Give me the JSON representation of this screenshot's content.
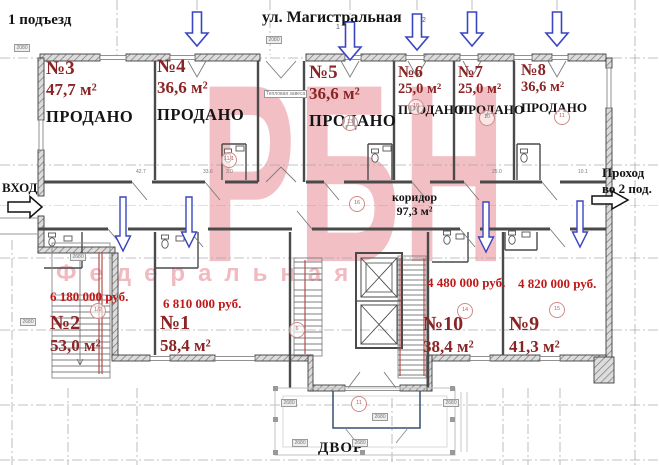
{
  "header": {
    "entrance": "1 подъезд",
    "street": "ул. Магистральная"
  },
  "labels": {
    "entrance_in": "ВХОД",
    "passage_line1": "Проход",
    "passage_line2": "во 2 под.",
    "yard": "ДВОР",
    "corridor_name": "коридор",
    "corridor_area": "97,3 м²",
    "vestibule": "Тепловая завеса"
  },
  "watermark": {
    "main": "РБН",
    "sub": "Федеральная"
  },
  "apartments": {
    "top": [
      {
        "num": "№3",
        "area": "47,7 м²",
        "status": "ПРОДАНО"
      },
      {
        "num": "№4",
        "area": "36,6 м²",
        "status": "ПРОДАНО"
      },
      {
        "num": "№5",
        "area": "36,6 м²",
        "status": "ПРОДАНО"
      },
      {
        "num": "№6",
        "area": "25,0 м²",
        "status": "ПРОДАНО"
      },
      {
        "num": "№7",
        "area": "25,0 м²",
        "status": "ПРОДАНО"
      },
      {
        "num": "№8",
        "area": "36,6 м²",
        "status": "ПРОДАНО"
      }
    ],
    "bottom": [
      {
        "num": "№2",
        "area": "53,0 м²",
        "price": "6 180 000 руб."
      },
      {
        "num": "№1",
        "area": "58,4 м²",
        "price": "6 810 000 руб."
      },
      {
        "num": "№10",
        "area": "38,4 м²",
        "price": "4 480 000 руб."
      },
      {
        "num": "№9",
        "area": "41,3 м²",
        "price": "4 820 000 руб."
      }
    ]
  },
  "tags": [
    "1/2",
    "16",
    "11/1",
    "14",
    "15",
    "10",
    "11",
    "18",
    "13",
    "6",
    "11"
  ],
  "dims": [
    "42.7",
    "33.6",
    "3.0",
    "25.0",
    "10.1"
  ],
  "dim_boxes": [
    "2080",
    "2080",
    "2680",
    "2680",
    "2680",
    "2680",
    "2680",
    "2680",
    "2680"
  ],
  "arrow_marks": [
    "1",
    "2"
  ],
  "colors": {
    "apartment_text": "#8b2525",
    "price_text": "#c01818",
    "sold_text": "#141414",
    "arrow_blue": "#3946c0",
    "watermark_pink": "#df6973",
    "wall": "#3d3d3d",
    "axis": "#9aa0a8"
  }
}
